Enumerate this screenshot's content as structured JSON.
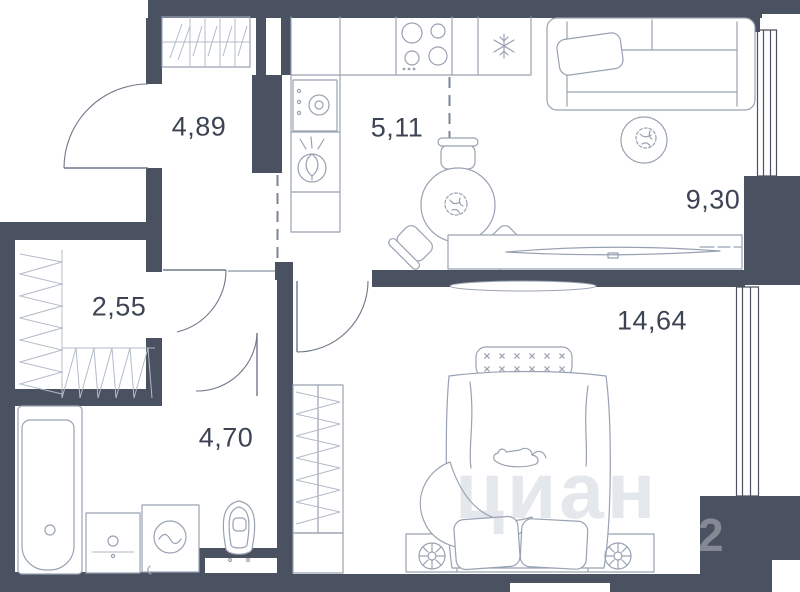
{
  "plan": {
    "type": "apartment-floor-plan",
    "rooms": [
      {
        "id": "hallway",
        "area_label": "4,89"
      },
      {
        "id": "kitchen",
        "area_label": "5,11"
      },
      {
        "id": "living-room",
        "area_label": "9,30"
      },
      {
        "id": "wardrobe",
        "area_label": "2,55"
      },
      {
        "id": "bathroom",
        "area_label": "4,70"
      },
      {
        "id": "bedroom",
        "area_label": "14,64"
      }
    ],
    "watermark": {
      "text": "циан",
      "digit": "2"
    },
    "icons": [
      "stove-icon",
      "fridge-snowflake-icon",
      "kitchen-sink-icon",
      "washing-machine-icon",
      "dining-table-icon",
      "chair-icon",
      "sofa-icon",
      "rug-plant-icon",
      "tv-console-icon",
      "bed-icon",
      "nightstand-lamp-icon",
      "wardrobe-hatch-icon",
      "bathtub-icon",
      "vanity-icon",
      "washer-icon",
      "toilet-icon",
      "door-arc-icon",
      "window-icon"
    ],
    "colors": {
      "wall": "#4a5161",
      "furniture_stroke": "#99a2b2",
      "hatch": "#b3bbc8",
      "label": "#3c4353",
      "dashed_zoning": "#7b8496",
      "background": "#ffffff"
    }
  }
}
